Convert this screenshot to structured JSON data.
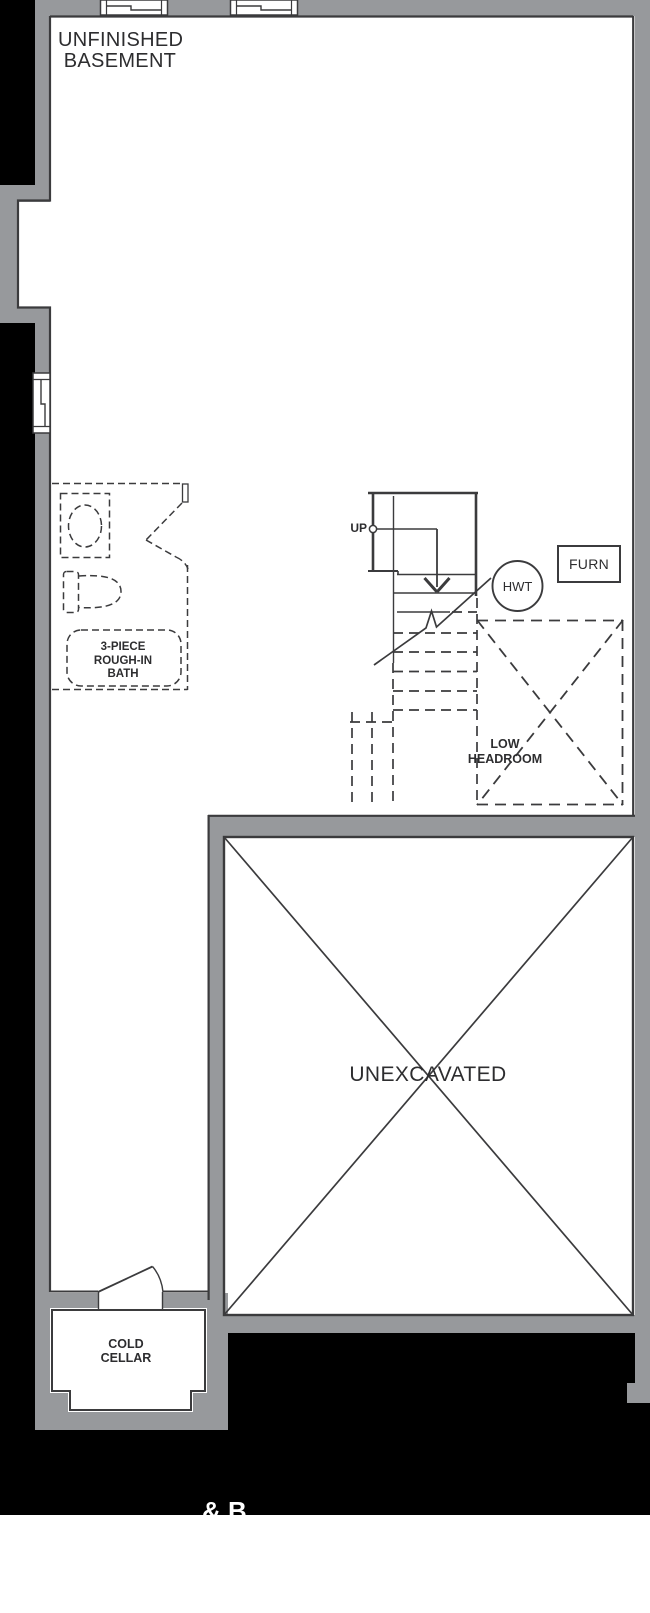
{
  "floorplan": {
    "title_lines": [
      "UNFINISHED",
      "BASEMENT"
    ],
    "stairs": {
      "up_label": "UP"
    },
    "equipment": {
      "hot_water_tank": "HWT",
      "furnace": "FURN"
    },
    "rooms": {
      "bath": {
        "label_lines": [
          "3-PIECE",
          "ROUGH-IN",
          "BATH"
        ]
      },
      "low_headroom": {
        "label_lines": [
          "LOW",
          "HEADROOM"
        ]
      },
      "unexcavated": {
        "label": "UNEXCAVATED"
      },
      "cold_cellar": {
        "label_lines": [
          "COLD",
          "CELLAR"
        ]
      }
    },
    "footer_fragment": "& B",
    "colors": {
      "wall_gray": "#97999C",
      "exterior_black": "#000000",
      "line_dark": "#3B3B3D",
      "interior_white": "#FFFFFF"
    }
  }
}
